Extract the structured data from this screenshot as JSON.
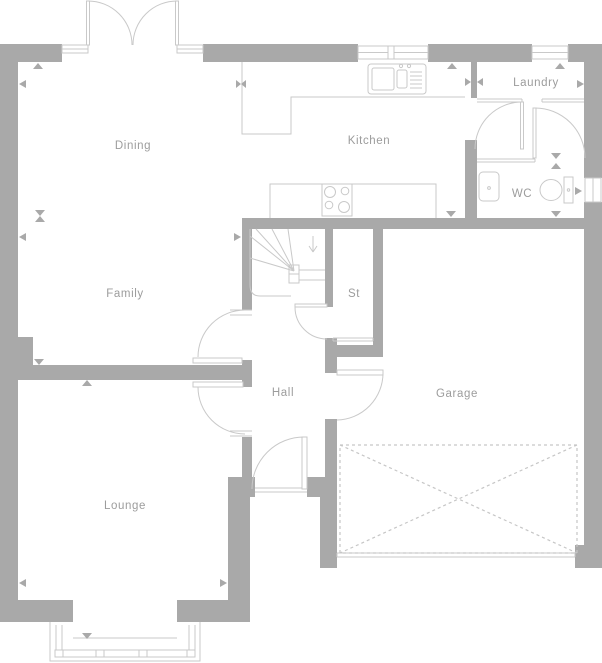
{
  "colors": {
    "wall": "#a9a9a9",
    "line": "#c9c9c9",
    "dashed": "#c6c6c6",
    "label": "#9c9c9c",
    "background": "#ffffff"
  },
  "rooms": [
    {
      "id": "dining",
      "label": "Dining"
    },
    {
      "id": "kitchen",
      "label": "Kitchen"
    },
    {
      "id": "laundry",
      "label": "Laundry"
    },
    {
      "id": "wc",
      "label": "WC"
    },
    {
      "id": "family",
      "label": "Family"
    },
    {
      "id": "store",
      "label": "St"
    },
    {
      "id": "hall",
      "label": "Hall"
    },
    {
      "id": "garage",
      "label": "Garage"
    },
    {
      "id": "lounge",
      "label": "Lounge"
    }
  ]
}
